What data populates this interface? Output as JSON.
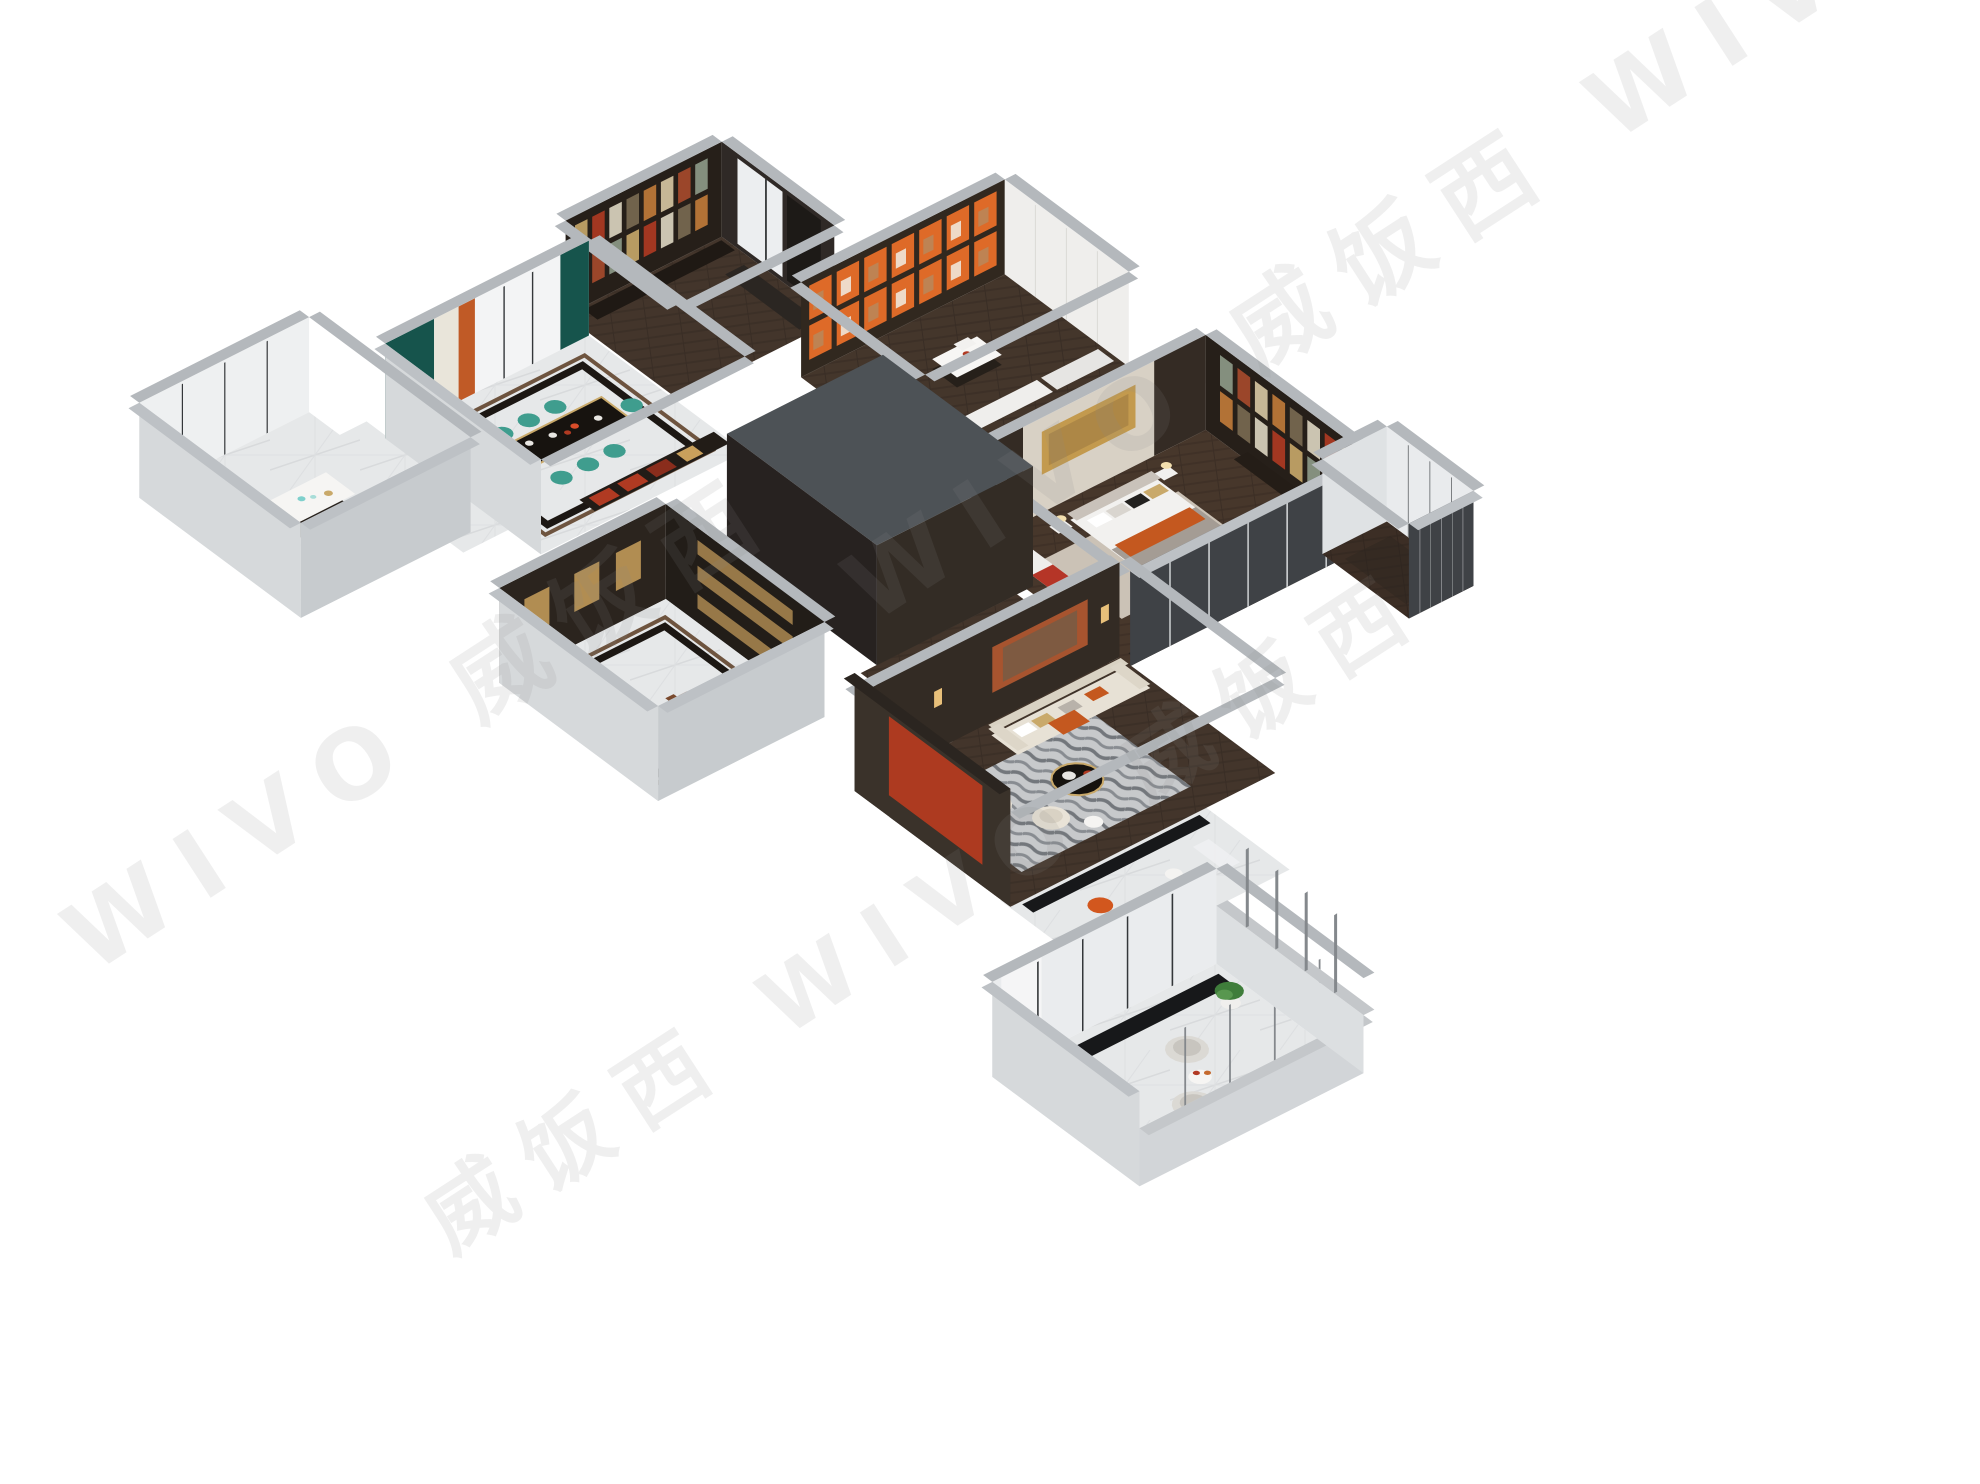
{
  "image": {
    "type": "3d-axonometric-apartment-floorplan-render",
    "background": "#ffffff"
  },
  "watermark": {
    "text": "WIVO 威饭西",
    "lines": [
      "WIVO 威饭西",
      "威饭西 WIVO 威饭西",
      "WIVO 威饭西 WIVO"
    ],
    "color": "#8b8b8b"
  },
  "palette": {
    "exterior_wall_gray": "#c7cbce",
    "wall_top_gray": "#b4b8bc",
    "dark_wood_wall": "#332b24",
    "dark_roof_box": "#4d5256",
    "marble_floor": "#e6e8e9",
    "dark_wood_floor": "#4a3a2f",
    "accent_orange": "#d2571e",
    "accent_red_panel": "#ad3a20",
    "wardrobe_red": "#b53527",
    "teal_chair": "#3f9d8e",
    "teal_curtain": "#16544c",
    "cream_sofa": "#e7e1d5",
    "brass_gold": "#c9a96a",
    "rug_gray": "#c7c9cb",
    "balcony_floor": "#d8dadc",
    "plant_green": "#3f7d3b"
  },
  "rooms": [
    {
      "name": "kitchen-bar"
    },
    {
      "name": "dining-room"
    },
    {
      "name": "study"
    },
    {
      "name": "walk-in-closet"
    },
    {
      "name": "enclosed-bathroom-box"
    },
    {
      "name": "entry-foyer"
    },
    {
      "name": "living-room"
    },
    {
      "name": "master-bedroom"
    },
    {
      "name": "bay-window"
    },
    {
      "name": "sun-lounge"
    },
    {
      "name": "balcony"
    }
  ]
}
